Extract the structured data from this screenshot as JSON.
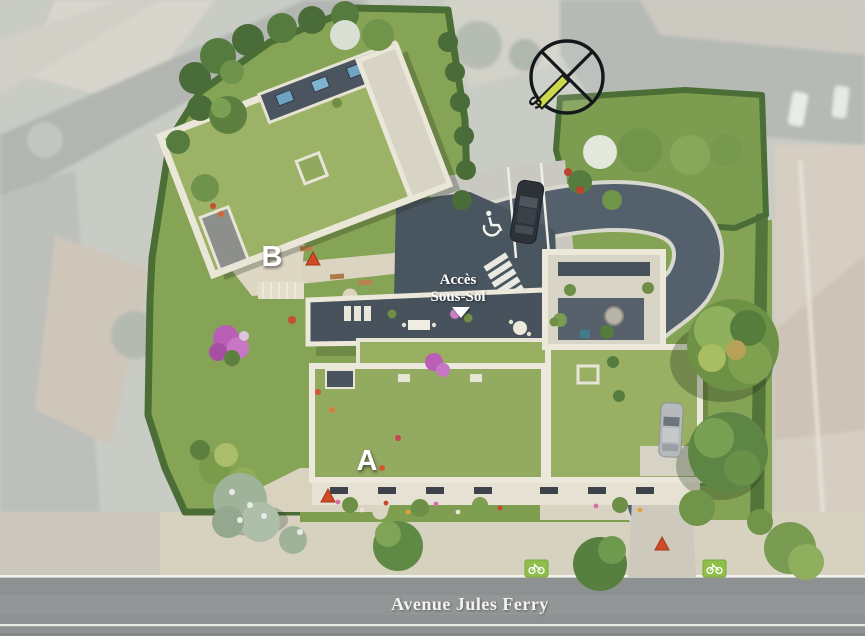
{
  "site_plan": {
    "labels": {
      "building_a": "A",
      "building_b": "B",
      "access_line1": "Accès",
      "access_line2": "Sous-Sol",
      "street_name": "Avenue Jules Ferry",
      "compass_south": "S"
    },
    "markers": {
      "entrance_marker_color": "#d14b28",
      "entrance_marker_count": 3,
      "bike_lane_marker_count": 2,
      "handicap_parking_spaces": 1
    },
    "colors": {
      "lawn": "#86a556",
      "green_roof": "#99ae63",
      "hedge": "#4b6d36",
      "driveway_asphalt": "#54606c",
      "ramp_asphalt": "#49555f",
      "road": "#8e9192",
      "sidewalk": "#d7d1c0",
      "parapet_white": "#ece8da",
      "terrace_dark": "#47525c",
      "stone_paving": "#d8d4c6",
      "bike_lane_green": "#8fbf4a",
      "compass_needle": "#cdd94b"
    }
  }
}
